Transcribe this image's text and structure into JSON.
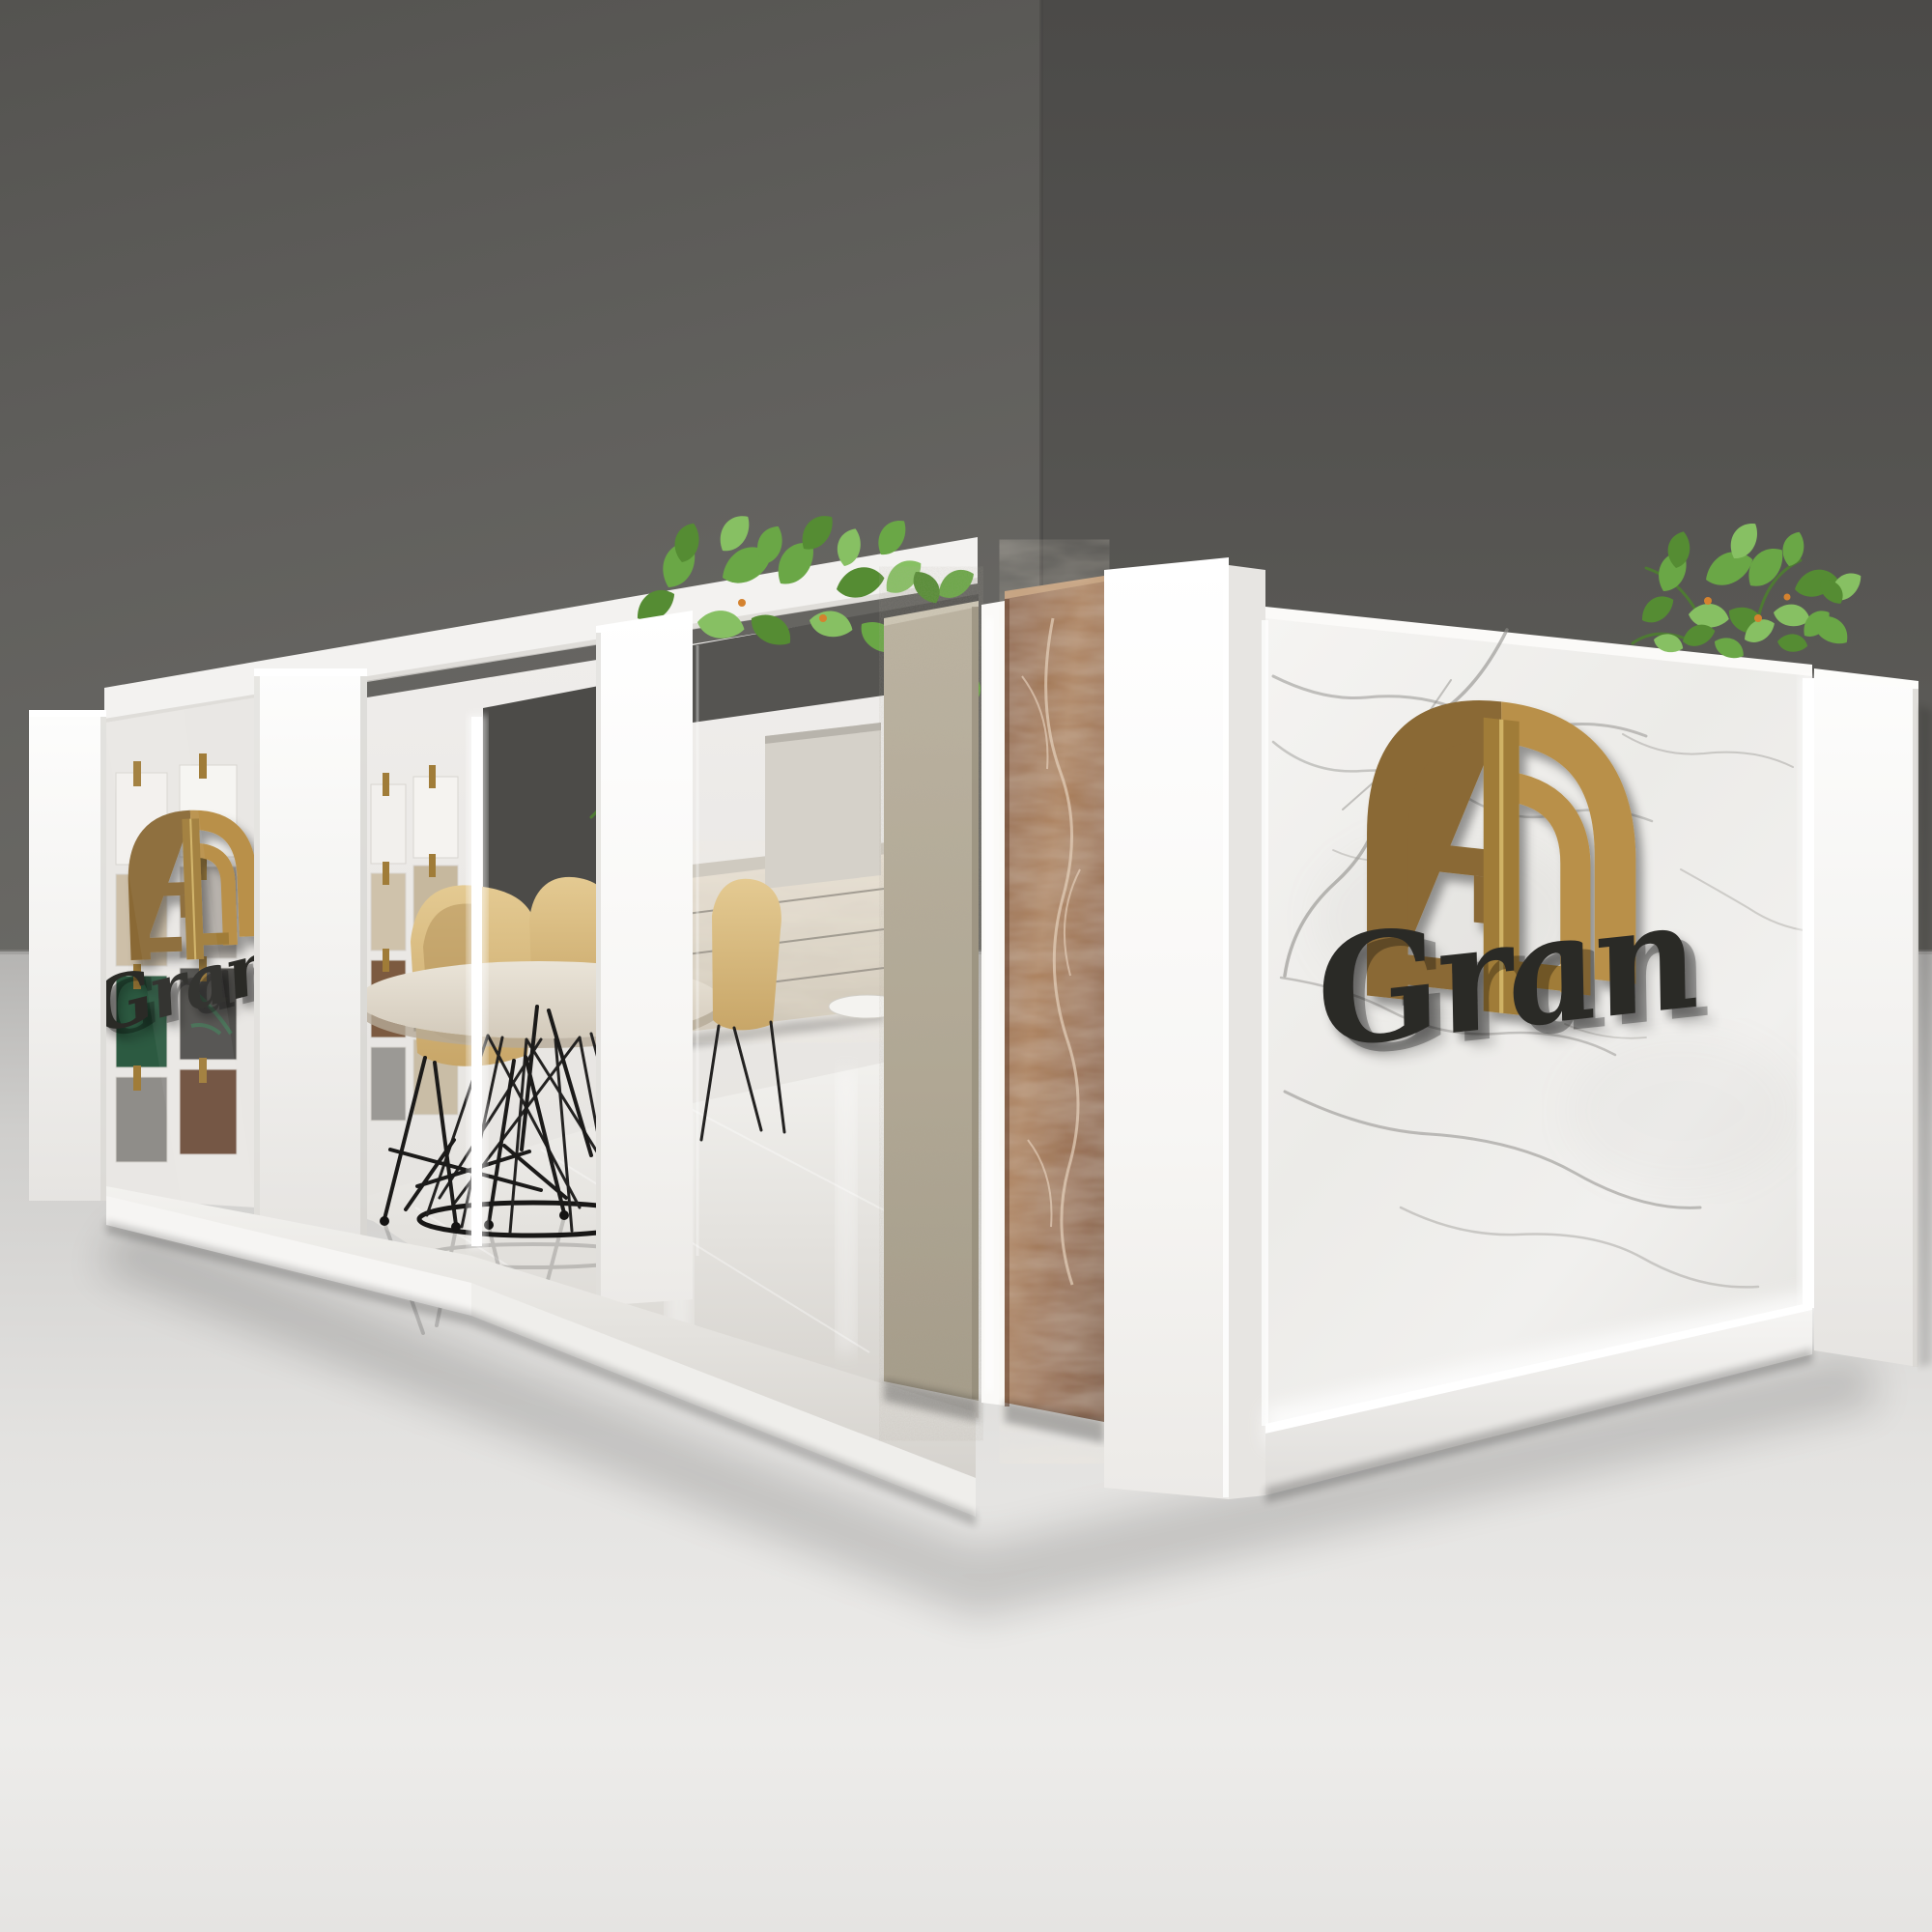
{
  "logo": {
    "script": "Gran",
    "emblem_icon": "arched-monogram-icon",
    "placements": [
      "glass-panel-left",
      "marble-wall-right"
    ]
  },
  "scene": {
    "kind": "3d-architectural-render",
    "subject": "stone-and-tile exhibition booth",
    "objects": [
      "backdrop-wall-left",
      "backdrop-wall-right",
      "showroom-ground",
      "booth-platform",
      "left-wall-pillars",
      "glass-showcase",
      "tile-sample-grid",
      "doorway-opening",
      "dining-table",
      "wood-wire-chairs",
      "floating-stone-vanity",
      "marble-planter",
      "trailing-plant",
      "granite-slab",
      "brown-marble-slab",
      "white-corner-pillar",
      "white-marble-logo-wall",
      "led-light-strips",
      "rooftop-plant",
      "right-end-pillar"
    ]
  },
  "colors": {
    "wall-left": "#615f5c",
    "wall-right": "#54534f",
    "ground": "#dcdbd9",
    "booth-white": "#f4f3f1",
    "marble-white": "#f1f0ed",
    "marble-vein": "#a3a29e",
    "gold": "#a07c38",
    "gold-light": "#b9904a",
    "gold-dark": "#8a6936",
    "gold-seam": "#d9bc6e",
    "script-black": "#2a2927",
    "granite": "#b3a995",
    "brown-marble": "#9a6a49",
    "wood": "#d9b97f",
    "green-1": "#6aa746",
    "green-2": "#558c33",
    "green-3": "#87c063",
    "led": "#ffffff"
  }
}
